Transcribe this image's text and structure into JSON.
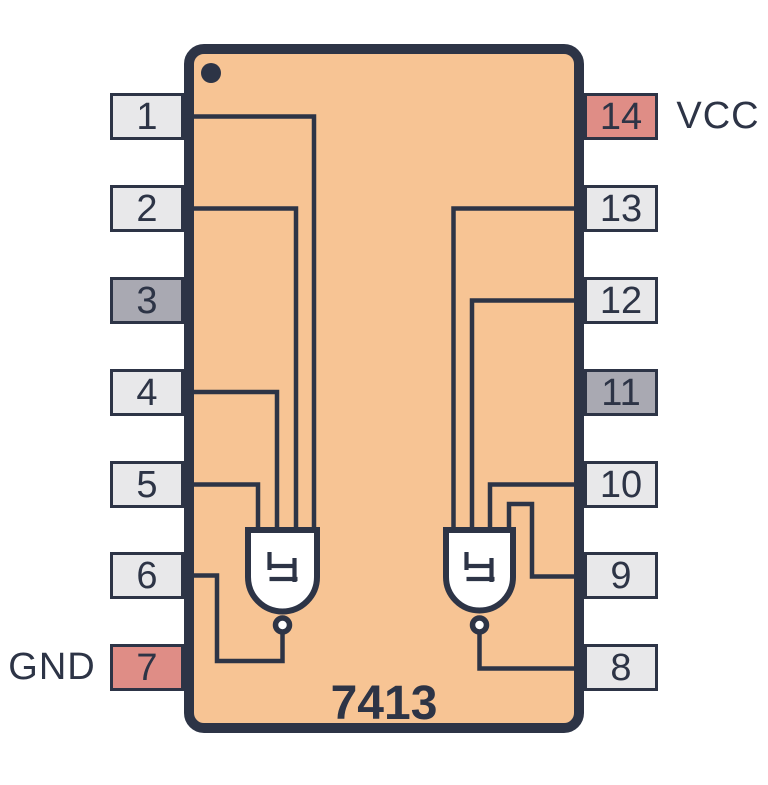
{
  "title": "7413 pinout diagram",
  "colors": {
    "background": "#ffffff",
    "outline": "#2d3446",
    "body": "#f7c494",
    "pin_default": "#e8e8ea",
    "pin_nc": "#a9a9b2",
    "pin_power": "#df8d86",
    "gate_fill": "#ffffff",
    "text": "#2d3446"
  },
  "chip": {
    "name": "7413",
    "left_pins": [
      {
        "number": "1",
        "variant": "default"
      },
      {
        "number": "2",
        "variant": "default"
      },
      {
        "number": "3",
        "variant": "nc"
      },
      {
        "number": "4",
        "variant": "default"
      },
      {
        "number": "5",
        "variant": "default"
      },
      {
        "number": "6",
        "variant": "default"
      },
      {
        "number": "7",
        "variant": "power",
        "label": "GND"
      }
    ],
    "right_pins": [
      {
        "number": "14",
        "variant": "power",
        "label": "VCC"
      },
      {
        "number": "13",
        "variant": "default"
      },
      {
        "number": "12",
        "variant": "default"
      },
      {
        "number": "11",
        "variant": "nc"
      },
      {
        "number": "10",
        "variant": "default"
      },
      {
        "number": "9",
        "variant": "default"
      },
      {
        "number": "8",
        "variant": "default"
      }
    ]
  }
}
